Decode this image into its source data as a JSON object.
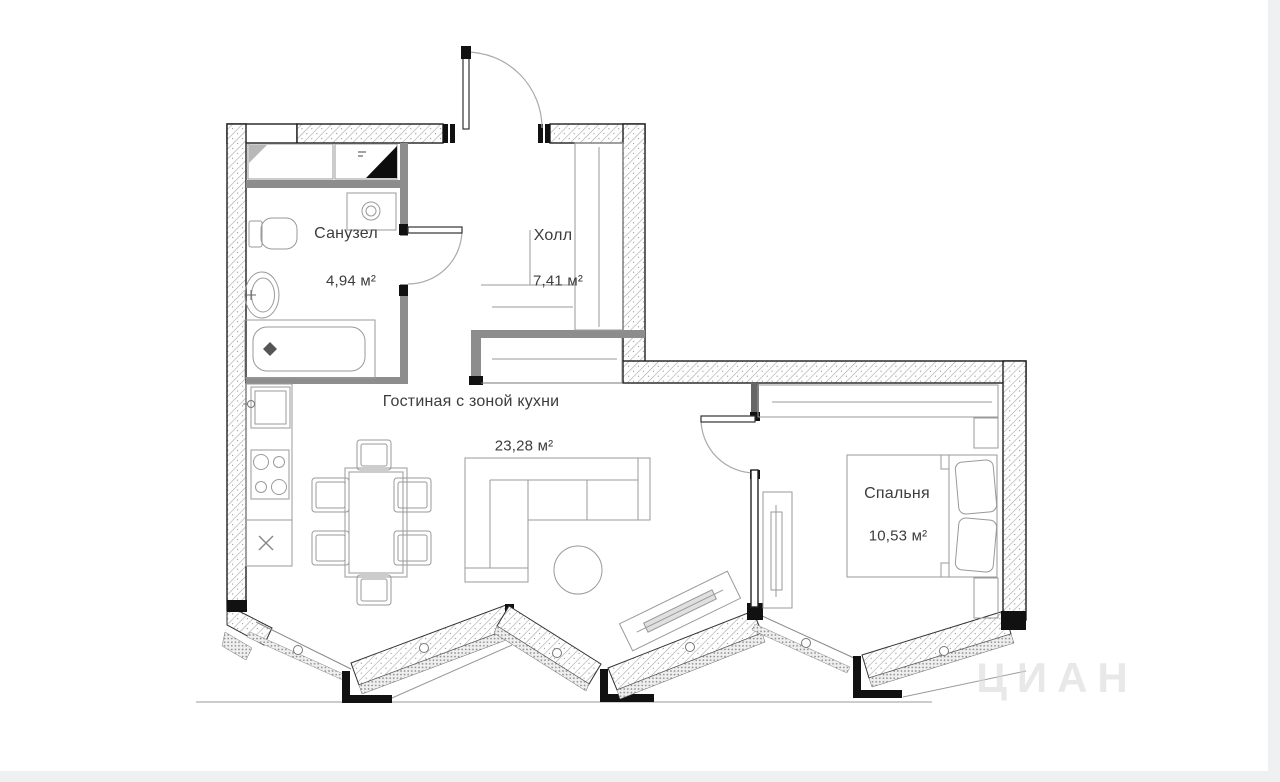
{
  "rooms": [
    {
      "name": "Санузел",
      "area": "4,94 м²"
    },
    {
      "name": "Холл",
      "area": "7,41 м²"
    },
    {
      "name": "Гостиная с зоной кухни",
      "area": "23,28 м²"
    },
    {
      "name": "Спальня",
      "area": "10,53 м²"
    }
  ],
  "watermark": "ЦИАН",
  "colors": {
    "wall_outline": "#1f1f1f",
    "wall_hatch": "#a8a8a8",
    "partition": "#8d8d8d",
    "furniture_line": "#9a9a9a",
    "label_text": "#3c3c3c",
    "watermark": "#d9d9d9",
    "page_margin": "#eef0f2"
  }
}
